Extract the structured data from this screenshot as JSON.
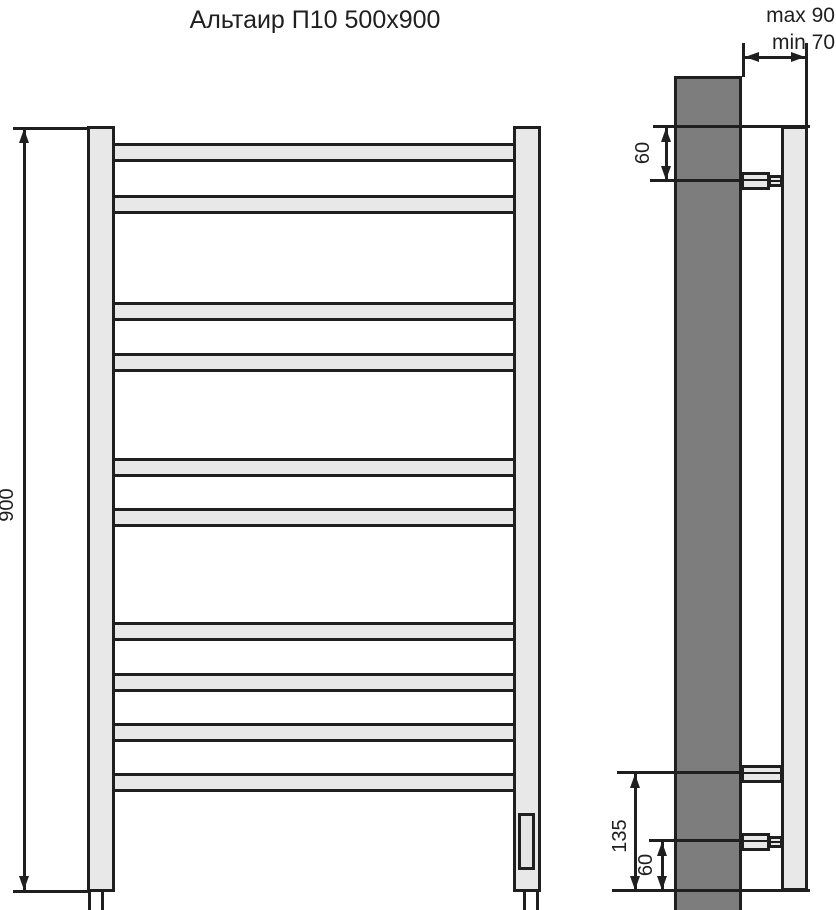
{
  "title": "Альтаир П10 500x900",
  "front_view": {
    "height_dimension": "900",
    "bar_count": 10
  },
  "side_view": {
    "wall_offset_max_label": "max 90",
    "wall_offset_min_label": "min 70",
    "top_bracket_offset": "60",
    "bottom_bracket_offset": "135",
    "bottom_element_offset": "60"
  }
}
